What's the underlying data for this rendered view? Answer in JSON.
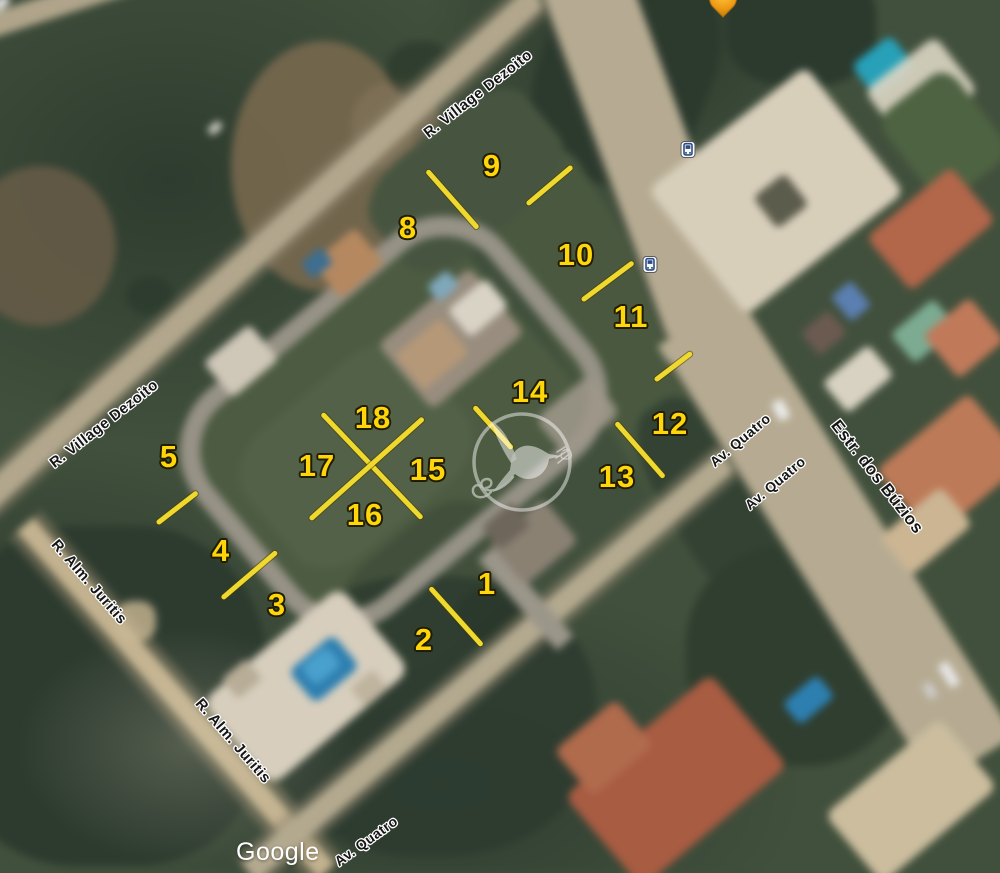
{
  "attribution": {
    "logo_text": "Google"
  },
  "colors": {
    "lot_number_yellow": "#FFD60A",
    "boundary_line_yellow": "#EFD92E",
    "street_label_text": "#161616",
    "street_label_outline": "#FFFFFF",
    "attribution_text": "#FFFFFF",
    "bus_icon_blue": "#2B4D85",
    "pin_orange": "#F09C16",
    "watermark_white": "#FFFFFF"
  },
  "streets": [
    {
      "id": "street-r-village-dezoito-top",
      "name": "R. Village Dezoito",
      "x": 478,
      "y": 94,
      "rot": -38,
      "size": 15
    },
    {
      "id": "street-r-village-dezoito-left",
      "name": "R. Village Dezoito",
      "x": 104,
      "y": 424,
      "rot": -38,
      "size": 15
    },
    {
      "id": "street-r-alm-juritis-upper",
      "name": "R. Alm. Juritis",
      "x": 89,
      "y": 582,
      "rot": 49,
      "size": 15
    },
    {
      "id": "street-r-alm-juritis-lower",
      "name": "R. Alm. Juritis",
      "x": 233,
      "y": 741,
      "rot": 49,
      "size": 15
    },
    {
      "id": "street-av-quatro-upper",
      "name": "Av. Quatro",
      "x": 740,
      "y": 440,
      "rot": -40,
      "size": 14
    },
    {
      "id": "street-av-quatro-mid",
      "name": "Av. Quatro",
      "x": 775,
      "y": 483,
      "rot": -40,
      "size": 14
    },
    {
      "id": "street-av-quatro-bottom",
      "name": "Av. Quatro",
      "x": 366,
      "y": 841,
      "rot": -36,
      "size": 14
    },
    {
      "id": "street-estr-dos-buzios",
      "name": "Estr. dos Búzios",
      "x": 877,
      "y": 477,
      "rot": 52,
      "size": 17
    }
  ],
  "lots": [
    {
      "number": "1",
      "x": 487,
      "y": 584
    },
    {
      "number": "2",
      "x": 424,
      "y": 640
    },
    {
      "number": "3",
      "x": 277,
      "y": 605
    },
    {
      "number": "4",
      "x": 221,
      "y": 551
    },
    {
      "number": "5",
      "x": 169,
      "y": 457
    },
    {
      "number": "8",
      "x": 408,
      "y": 228
    },
    {
      "number": "9",
      "x": 492,
      "y": 166
    },
    {
      "number": "10",
      "x": 576,
      "y": 255
    },
    {
      "number": "11",
      "x": 631,
      "y": 317
    },
    {
      "number": "12",
      "x": 670,
      "y": 424
    },
    {
      "number": "13",
      "x": 617,
      "y": 477
    },
    {
      "number": "14",
      "x": 530,
      "y": 392
    },
    {
      "number": "15",
      "x": 428,
      "y": 470
    },
    {
      "number": "16",
      "x": 365,
      "y": 515
    },
    {
      "number": "17",
      "x": 317,
      "y": 466
    },
    {
      "number": "18",
      "x": 373,
      "y": 418
    }
  ],
  "boundary_lines": [
    {
      "id": "line-8-9",
      "x1": 427,
      "y1": 170,
      "x2": 478,
      "y2": 228
    },
    {
      "id": "line-9-10",
      "x1": 527,
      "y1": 204,
      "x2": 572,
      "y2": 166
    },
    {
      "id": "line-10-11",
      "x1": 582,
      "y1": 300,
      "x2": 633,
      "y2": 262
    },
    {
      "id": "line-11-12",
      "x1": 655,
      "y1": 380,
      "x2": 692,
      "y2": 352
    },
    {
      "id": "line-12-13",
      "x1": 616,
      "y1": 422,
      "x2": 664,
      "y2": 477
    },
    {
      "id": "line-14-15",
      "x1": 474,
      "y1": 406,
      "x2": 512,
      "y2": 448
    },
    {
      "id": "line-x-arm-1",
      "x1": 322,
      "y1": 413,
      "x2": 422,
      "y2": 518
    },
    {
      "id": "line-x-arm-2",
      "x1": 310,
      "y1": 519,
      "x2": 423,
      "y2": 418
    },
    {
      "id": "line-1-2",
      "x1": 430,
      "y1": 587,
      "x2": 482,
      "y2": 645
    },
    {
      "id": "line-3-4",
      "x1": 222,
      "y1": 598,
      "x2": 277,
      "y2": 551
    },
    {
      "id": "line-4-5",
      "x1": 157,
      "y1": 523,
      "x2": 197,
      "y2": 492
    }
  ],
  "transit_stops": [
    {
      "id": "bus-stop-north",
      "x": 688,
      "y": 152
    },
    {
      "id": "bus-stop-south",
      "x": 650,
      "y": 267
    }
  ]
}
